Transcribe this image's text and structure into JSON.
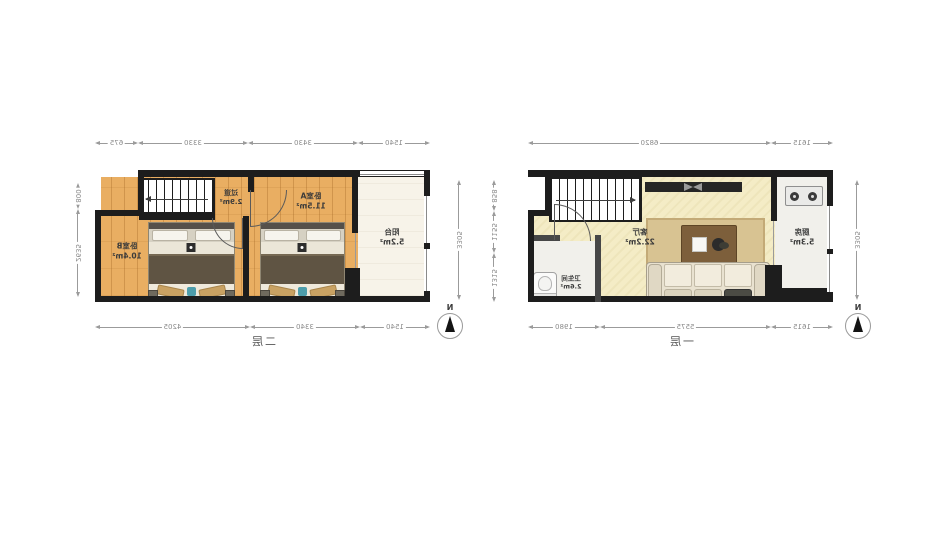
{
  "compass": {
    "label": "N"
  },
  "floors": {
    "first": {
      "title": "一层",
      "rooms": {
        "living": {
          "name": "客厅",
          "area": "22.2m²"
        },
        "kitchen": {
          "name": "厨房",
          "area": "5.3m²"
        },
        "bathroom": {
          "name": "卫生间",
          "area": "2.6m²"
        }
      },
      "dims": {
        "top": [
          "1615",
          "6820"
        ],
        "bottom": [
          "1615",
          "5575",
          "1980"
        ],
        "left": [
          "3305"
        ],
        "right": [
          "858",
          "1155",
          "1315"
        ]
      }
    },
    "second": {
      "title": "二层",
      "rooms": {
        "hallway": {
          "name": "过道",
          "area": "2.9m²"
        },
        "bedroomA": {
          "name": "卧室A",
          "area": "11.5m²"
        },
        "bedroomB": {
          "name": "卧室B",
          "area": "10.4m²"
        },
        "balcony": {
          "name": "阳台",
          "area": "5.2m²"
        }
      },
      "dims": {
        "top": [
          "1540",
          "3430",
          "3330",
          "675"
        ],
        "bottom": [
          "1540",
          "3340",
          "4205"
        ],
        "left": [
          "3305"
        ],
        "right": [
          "800",
          "2635"
        ]
      }
    }
  },
  "colors": {
    "wall": "#1d1d1d",
    "wood_floor": "#e9ae62",
    "living_floor": "#f4ecc6",
    "light_floor": "#f1f0eb",
    "balcony_floor": "#f7f3e9",
    "accent_teal": "#4d9dab"
  }
}
